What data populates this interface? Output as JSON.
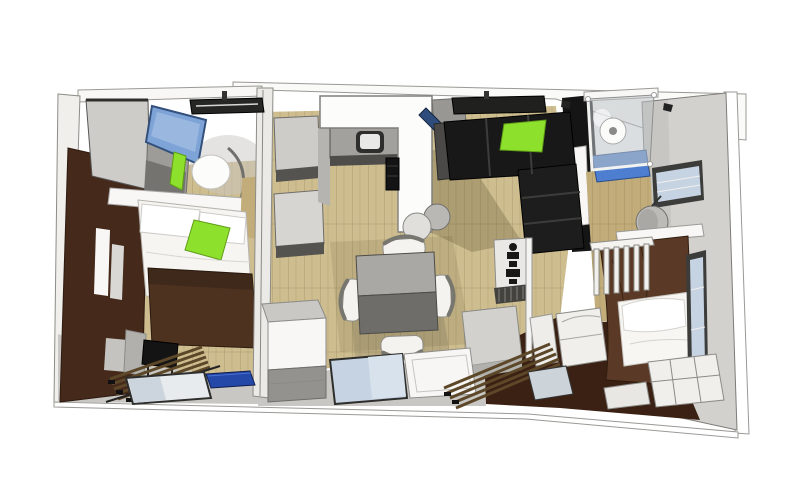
{
  "scene": {
    "title": "3D top-down interior floor plan render",
    "view": "bird's-eye oblique, roof removed",
    "rooms": [
      {
        "name": "master-bedroom",
        "position": "left",
        "furniture": [
          "double-bed",
          "white-duvet",
          "brown-blanket",
          "green-accent-pillow",
          "overhead-cabinets",
          "mounted-tv-screen",
          "headboard-shelf",
          "round-headboard-lamp",
          "wall-niches",
          "black-side-table",
          "slatted-bench",
          "roof-hatch"
        ]
      },
      {
        "name": "kitchen",
        "position": "top-center",
        "furniture": [
          "l-shaped-white-counter",
          "inset-sink",
          "oven-column",
          "round-stools",
          "tall-cabinets",
          "leaning-blue-board",
          "roof-hatch"
        ]
      },
      {
        "name": "living-dining",
        "position": "center",
        "furniture": [
          "square-dining-table",
          "four-white-chairs",
          "corner-sofa",
          "green-sofa-cushion",
          "entrance-cabinet",
          "totem-decor-panel",
          "heater-grille",
          "support-pole",
          "gray-bench",
          "laundry-bin",
          "sketch-chair",
          "glazed-door",
          "white-door",
          "blue-doormat",
          "slatted-steps"
        ]
      },
      {
        "name": "bathroom",
        "position": "top-right",
        "furniture": [
          "walk-in-shower",
          "shower-head",
          "blue-shower-tray",
          "black-feature-wall",
          "towel",
          "wood-clad-half-wall"
        ]
      },
      {
        "name": "kids-bedroom",
        "position": "right",
        "furniture": [
          "single-bed",
          "white-pillows",
          "bunk-railing-ladder",
          "storage-drawers",
          "satellite-dish",
          "wall-shelf",
          "high-window",
          "side-window"
        ]
      }
    ]
  },
  "palette": {
    "bg": "#ffffff",
    "ceiling": "#fafaf8",
    "wall_gray": "#d3d1cd",
    "wall_brown": "#45291b",
    "wood": "#cdbd8f",
    "wood_dark": "#c2ad7a",
    "floor_dark": "#3a2113",
    "apron": "#c8c7c3",
    "bed_brown": "#4e3220",
    "bed_brown2": "#5a3a26",
    "green": "#8de12d",
    "tv_blue": "#7ea4d7",
    "glass": "#c6d3e2",
    "shower_blue": "#4d7ecf",
    "mat_blue": "#2448a8",
    "board_blue": "#2e4d7d",
    "black": "#151515",
    "sofa_black": "#181818",
    "counter": "#fcfcfb",
    "steel": "#a2a19d",
    "cabinet": "#cdccc8",
    "table_light": "#a9a8a5",
    "table_dark": "#6e6d6a",
    "slat": "#5c4729",
    "white": "#f8f7f5"
  }
}
